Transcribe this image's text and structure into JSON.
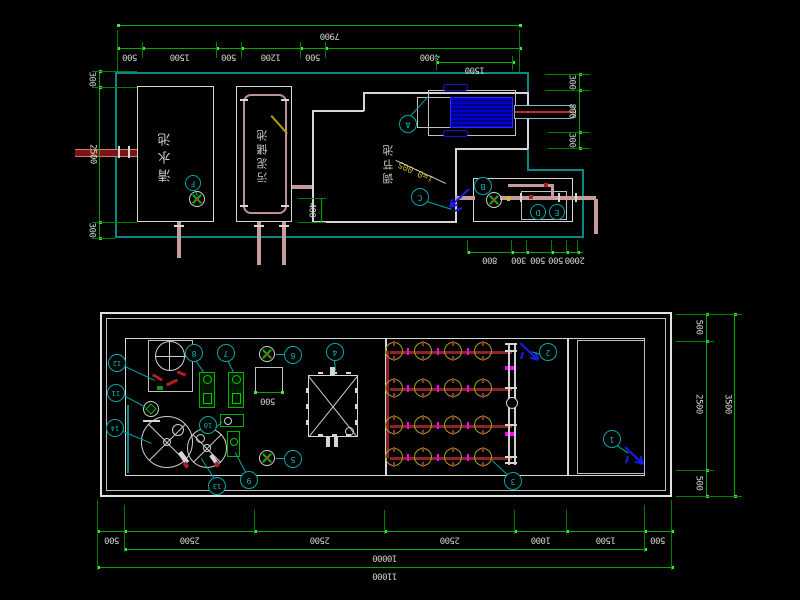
{
  "drawing": {
    "top_view": {
      "tank_labels": [
        "清水池",
        "污泥储池",
        "调节池"
      ],
      "slope_label": "i=0.005",
      "callouts": [
        "A",
        "B",
        "C",
        "D",
        "E",
        "F"
      ],
      "dims": {
        "overall_width": "7900",
        "top_segments": [
          "500",
          "1500",
          "500",
          "1200",
          "500",
          "4000"
        ],
        "top_sub_segment": "1500",
        "left_side": [
          "300",
          "2500",
          "300"
        ],
        "right_side": [
          "300",
          "800",
          "300"
        ],
        "bottom_segments": [
          "800",
          "300",
          "500",
          "500",
          "2000"
        ],
        "wall_offset": "400"
      }
    },
    "bottom_view": {
      "callouts": [
        "1",
        "2",
        "3",
        "4",
        "5",
        "6",
        "7",
        "8",
        "9",
        "10",
        "11",
        "12",
        "13",
        "14"
      ],
      "dims": {
        "right_side": [
          "500",
          "2500",
          "500"
        ],
        "right_total": "3500",
        "bottom_segments": [
          "500",
          "2500",
          "2500",
          "2500",
          "1000",
          "1500",
          "500"
        ],
        "bottom_inner_total": "10000",
        "bottom_overall_total": "11000",
        "platform_width": "500"
      }
    },
    "colors": {
      "dimension_line": "#00a800",
      "dimension_text": "#cdd5cd",
      "wall": "#d6d6d6",
      "boundary": "#0a8888",
      "pipe": "#c79b9b",
      "aeration_pipe": "#8b2525",
      "equipment_green": "#00b400",
      "equipment_blue": "#0000c8",
      "callout": "#00a8a8",
      "diffuser": "#ad9f1f",
      "marker": "#ff00ff",
      "flow_arrow": "#1a1ae6",
      "slope_text": "#c8b400"
    }
  }
}
